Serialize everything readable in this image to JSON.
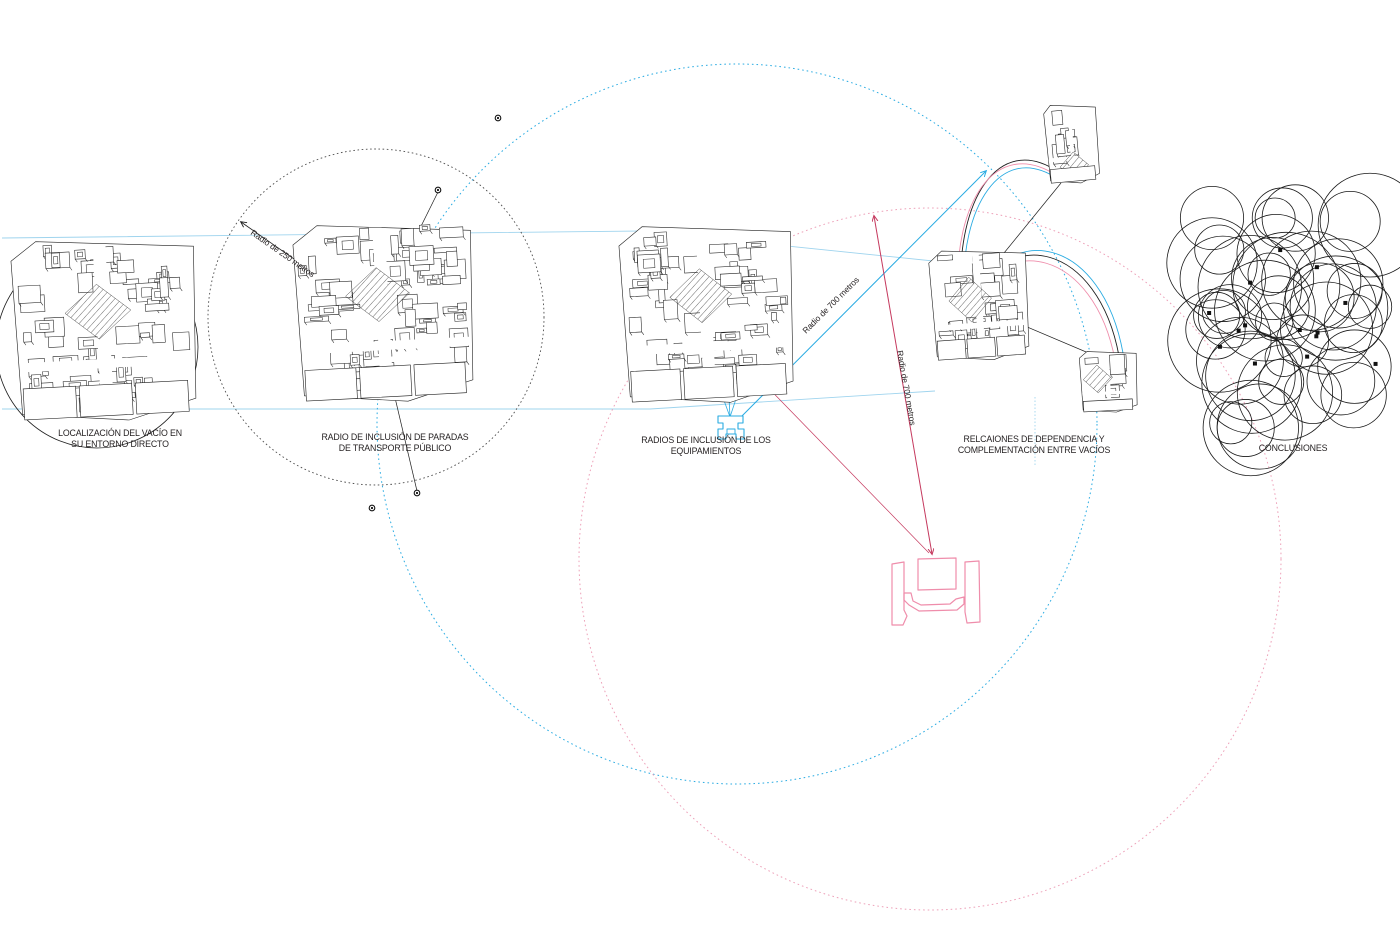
{
  "diagram": {
    "panels": [
      {
        "id": "localizacion",
        "label_lines": [
          "LOCALIZACIÓN DEL VACÍO EN",
          "SU ENTORNO DIRECTO"
        ]
      },
      {
        "id": "paradas",
        "label_lines": [
          "RADIO DE INCLUSIÓN DE PARADAS",
          "DE TRANSPORTE PÚBLICO"
        ]
      },
      {
        "id": "equipamientos",
        "label_lines": [
          "RADIOS DE INCLUSIÓN DE LOS",
          "EQUIPAMIENTOS"
        ]
      },
      {
        "id": "relaciones",
        "label_lines": [
          "RELCAIONES DE DEPENDENCIA Y",
          "COMPLEMENTACIÓN ENTRE VACÍOS"
        ]
      },
      {
        "id": "conclusiones",
        "label_lines": [
          "CONCLUSIONES"
        ]
      }
    ],
    "annotations": {
      "radius_250": "Radio de 250 metros",
      "radius_700_blue": "Radio de 700 metros",
      "radius_700_red": "Radio de 700 metros"
    },
    "colors": {
      "ink": "#1e1e1e",
      "grey": "#4d4d4d",
      "cyan": "#29abe2",
      "light_blue": "#9fd4ee",
      "pink": "#ef8dab",
      "pink_dot": "#eda0b8",
      "red": "#c5395e"
    }
  }
}
